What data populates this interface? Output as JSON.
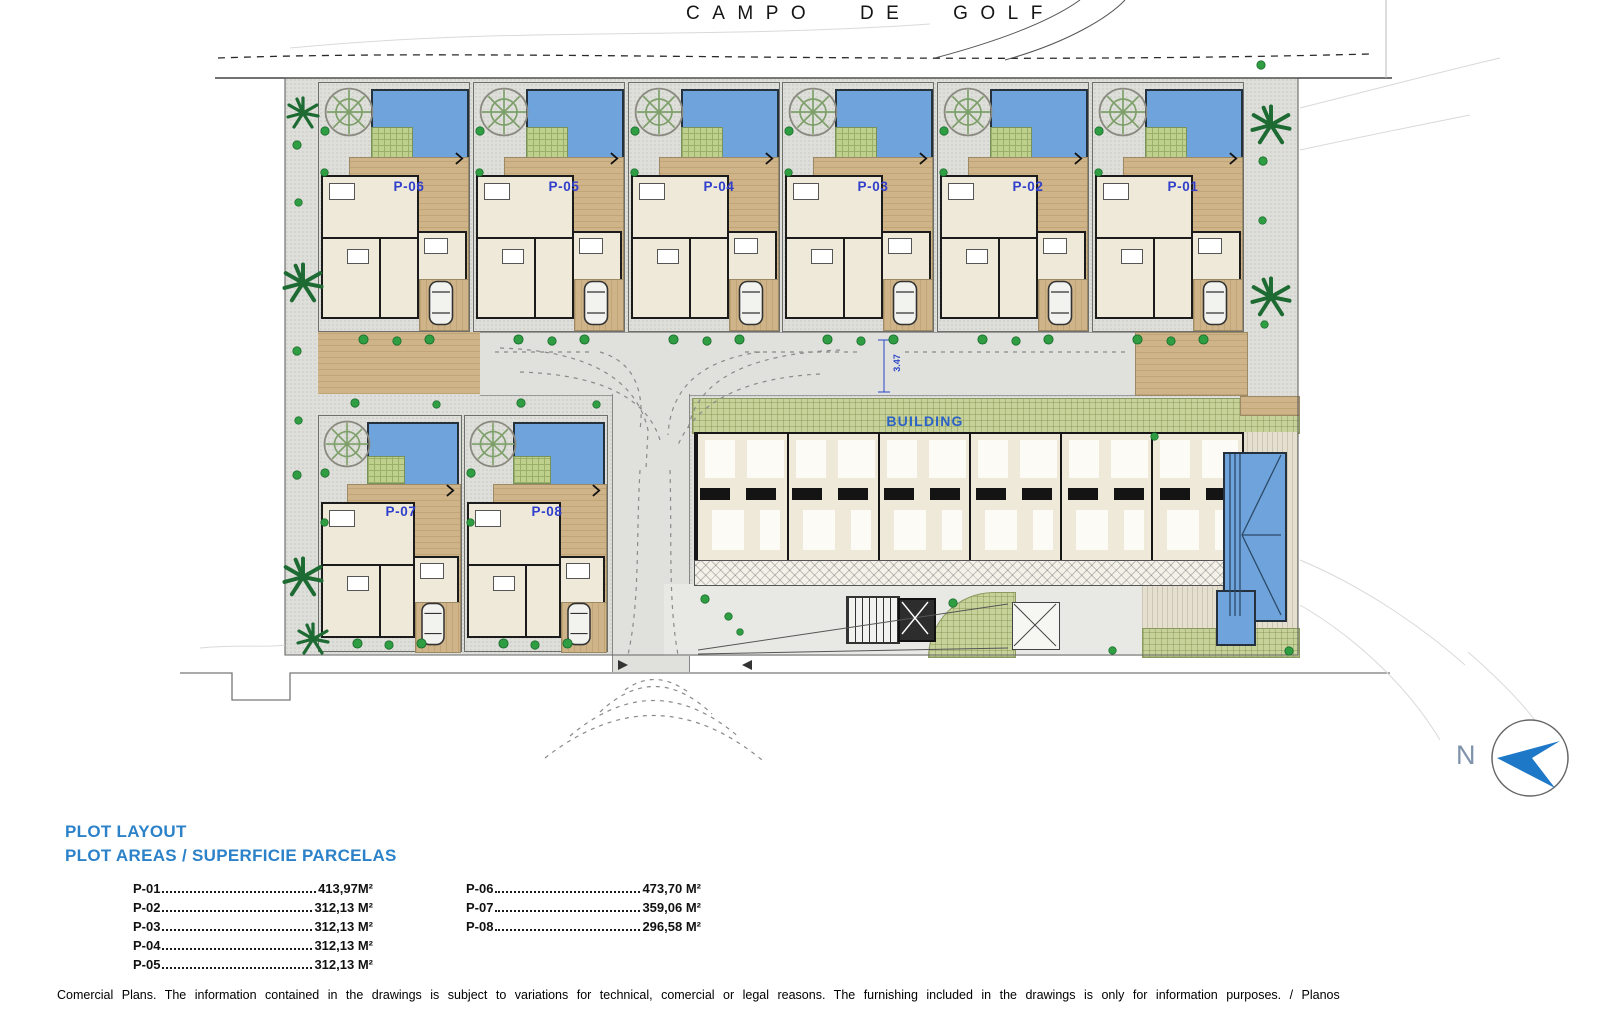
{
  "colors": {
    "plot_label_blue": "#3040cc",
    "legend_blue": "#2c82c9",
    "building_label_blue": "#2b62c6",
    "pool_blue": "#6fa3dc",
    "deck_tan": "#cfb489",
    "lawn_green": "#c7d19a",
    "north_arrow_blue": "#1e78c8"
  },
  "icons": {
    "north_arrow": "compass-arrow-icon",
    "tree": "tree-icon",
    "bush": "bush-icon",
    "palm": "palm-tree-icon",
    "car": "car-icon",
    "gate_chevron": "chevron-right-icon"
  },
  "header": {
    "title": "CAMPO DE GOLF"
  },
  "plan": {
    "building_label": "BUILDING",
    "road_dimension": "3.47",
    "plots": [
      {
        "id": "P-06"
      },
      {
        "id": "P-05"
      },
      {
        "id": "P-04"
      },
      {
        "id": "P-03"
      },
      {
        "id": "P-02"
      },
      {
        "id": "P-01"
      },
      {
        "id": "P-07"
      },
      {
        "id": "P-08"
      }
    ]
  },
  "north_arrow": {
    "label": "N"
  },
  "legend": {
    "title_line1": "PLOT LAYOUT",
    "title_line2": "PLOT AREAS / SUPERFICIE PARCELAS",
    "column1": [
      {
        "label": "P-01",
        "value": "413,97M²"
      },
      {
        "label": "P-02",
        "value": "312,13 M²"
      },
      {
        "label": "P-03",
        "value": "312,13 M²"
      },
      {
        "label": "P-04",
        "value": "312,13 M²"
      },
      {
        "label": "P-05",
        "value": "312,13 M²"
      }
    ],
    "column2": [
      {
        "label": "P-06",
        "value": "473,70 M²"
      },
      {
        "label": "P-07",
        "value": "359,06 M²"
      },
      {
        "label": "P-08",
        "value": "296,58 M²"
      }
    ]
  },
  "footer": {
    "disclaimer": "Comercial Plans. The information contained in the drawings is subject to variations for technical, comercial or legal reasons. The furnishing included in the drawings is only for information purposes. / Planos"
  }
}
